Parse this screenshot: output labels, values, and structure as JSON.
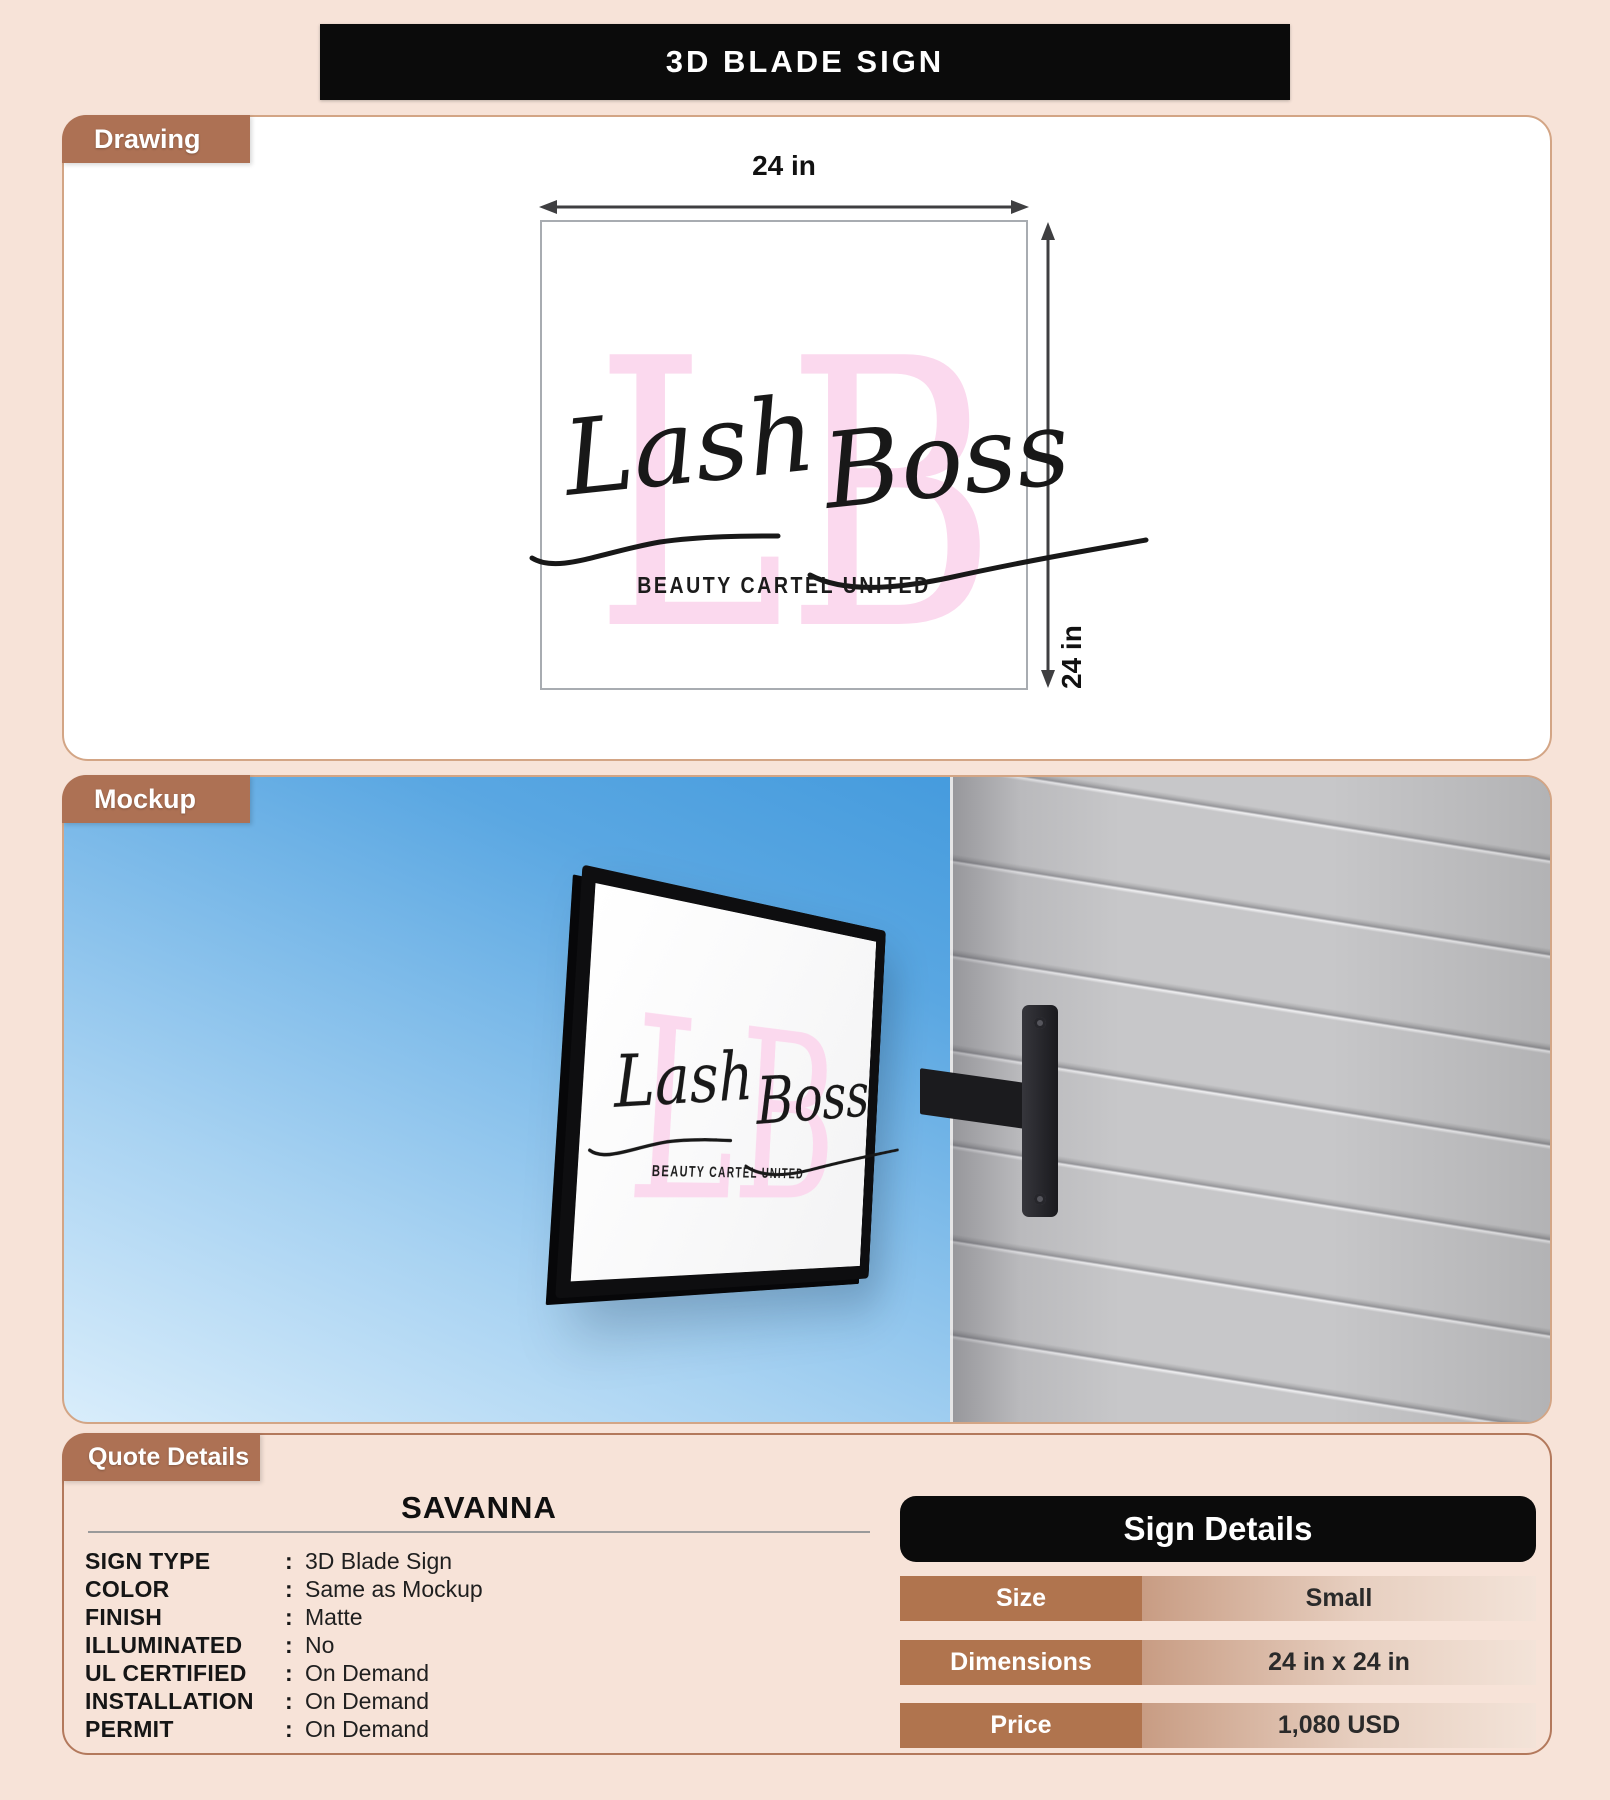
{
  "page": {
    "title": "3D BLADE SIGN"
  },
  "tabs": {
    "drawing": "Drawing",
    "mockup": "Mockup",
    "quote": "Quote Details"
  },
  "drawing": {
    "width_label": "24 in",
    "height_label": "24 in"
  },
  "logo": {
    "monogram": "LB",
    "script_first": "Lash",
    "script_second": "Boss",
    "tagline": "BEAUTY CARTEL UNITED"
  },
  "quote": {
    "name": "SAVANNA",
    "colon": ":",
    "fields": [
      {
        "label": "SIGN TYPE",
        "value": "3D Blade Sign"
      },
      {
        "label": "COLOR",
        "value": "Same as Mockup"
      },
      {
        "label": "FINISH",
        "value": "Matte"
      },
      {
        "label": "ILLUMINATED",
        "value": "No"
      },
      {
        "label": "UL CERTIFIED",
        "value": "On Demand"
      },
      {
        "label": "INSTALLATION",
        "value": "On Demand"
      },
      {
        "label": "PERMIT",
        "value": "On Demand"
      }
    ]
  },
  "sign_details": {
    "header": "Sign Details",
    "rows": [
      {
        "label": "Size",
        "value": "Small"
      },
      {
        "label": "Dimensions",
        "value": "24 in x 24 in"
      },
      {
        "label": "Price",
        "value": "1,080 USD"
      }
    ]
  },
  "colors": {
    "page_bg": "#f7e3d8",
    "accent_brown": "#ad7154",
    "table_key_brown": "#b0744e",
    "banner_black": "#0b0b0b",
    "logo_pink": "#fbd9ee",
    "sky_blue": "#2e8ed8",
    "wall_gray": "#c5c5c7"
  }
}
